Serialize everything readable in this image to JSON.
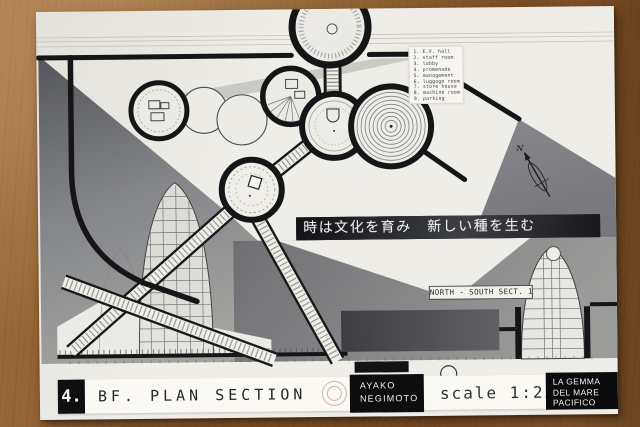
{
  "poster": {
    "legend": {
      "items": [
        "1. E.V. hall",
        "2. staff room",
        "3. lobby",
        "4. promenade",
        "5. management",
        "6. luggage room",
        "7. store house",
        "8. machine room",
        "9. parking"
      ]
    },
    "banner": {
      "text": "時は文化を育み　新しい種を生む"
    },
    "compass": {
      "label": "N"
    },
    "section_label": "NORTH - SOUTH SECT. 1",
    "title_block": {
      "number": "4.",
      "title": "BF. PLAN SECTION",
      "author_line1": "AYAKO",
      "author_line2": "NEGIMOTO",
      "scale": "scale 1:250",
      "project_line1": "LA GEMMA",
      "project_line2": "DEL MARE",
      "project_line3": "PACIFICO"
    },
    "colors": {
      "wood": "#8a5a2c",
      "paper": "#f2f0ea",
      "ink": "#17171a",
      "mountain_gray": "#84868a",
      "banner_bg": "#1f2024"
    }
  }
}
